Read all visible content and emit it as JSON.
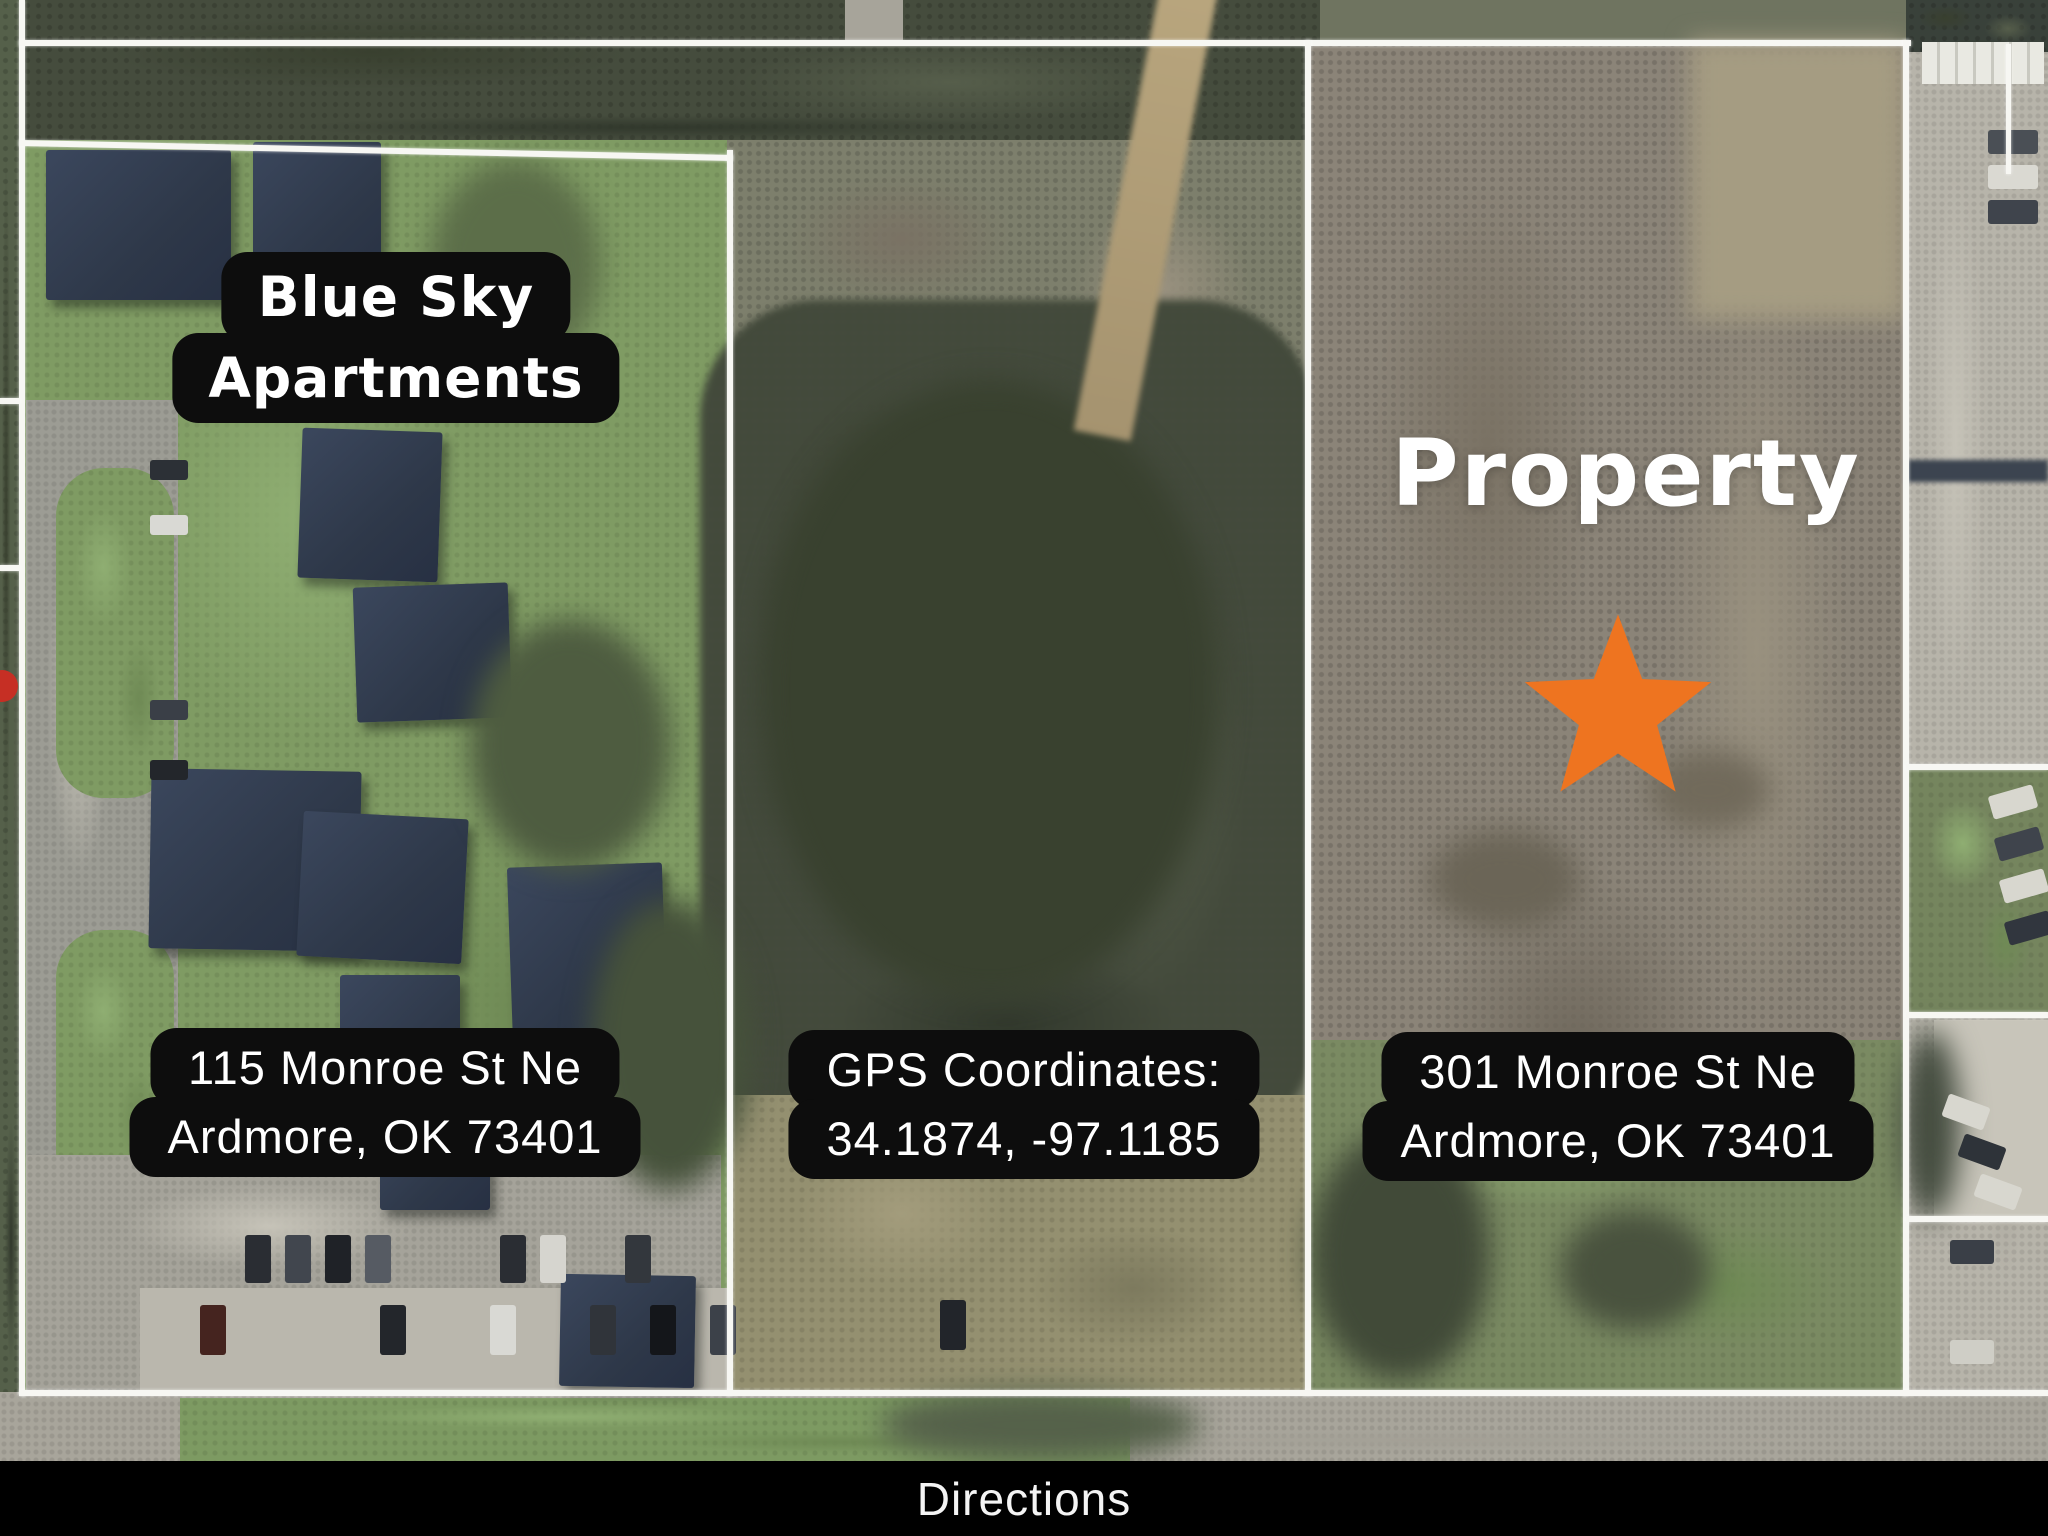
{
  "map": {
    "apartments_label": {
      "line1": "Blue Sky",
      "line2": "Apartments"
    },
    "property_label": "Property",
    "address_left": {
      "line1": "115 Monroe St Ne",
      "line2": "Ardmore, OK 73401"
    },
    "gps_label": {
      "line1": "GPS Coordinates:",
      "line2": "34.1874, -97.1185"
    },
    "address_right": {
      "line1": "301 Monroe St Ne",
      "line2": "Ardmore, OK 73401"
    },
    "marker": {
      "icon": "star-icon",
      "color": "#EE7420"
    }
  },
  "footer": {
    "directions_label": "Directions"
  },
  "colors": {
    "label_bg": "#0d0d0d",
    "label_text": "#ffffff",
    "boundary": "#ffffff",
    "marker_orange": "#EE7420",
    "footer_bg": "#000000"
  }
}
